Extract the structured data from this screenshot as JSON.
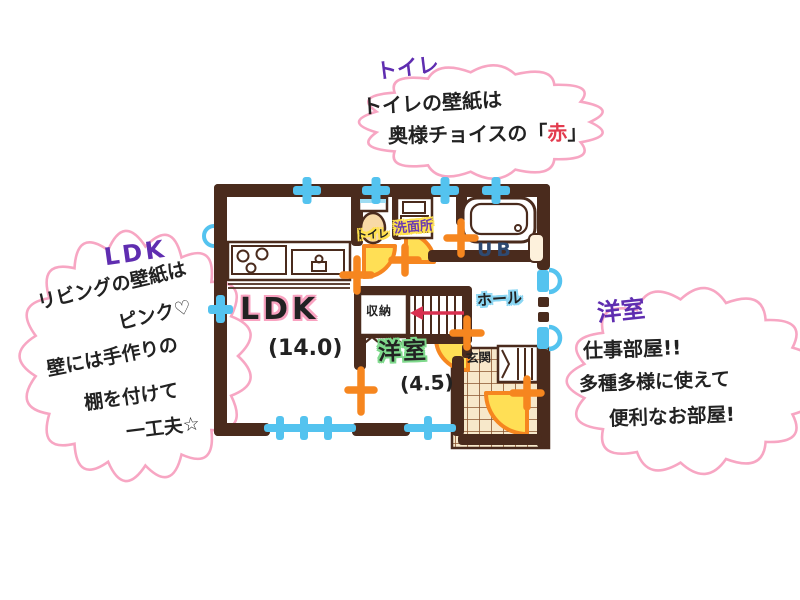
{
  "bubbles": {
    "toilet": {
      "title": "トイレ",
      "line1": "トイレの壁紙は",
      "line2_prefix": "奥様チョイスの「",
      "line2_accent": "赤",
      "line2_suffix": "」"
    },
    "ldk": {
      "title": "LDK",
      "lines": [
        "リビングの壁紙は",
        "ピンク♡",
        "壁には手作りの",
        "棚を付けて",
        "一工夫☆"
      ]
    },
    "youshitsu": {
      "title": "洋室",
      "lines": [
        "仕事部屋!!",
        "多種多様に使えて",
        "便利なお部屋!"
      ]
    }
  },
  "floorplan": {
    "rooms": {
      "ldk": {
        "name": "LDK",
        "size": "(14.0)"
      },
      "youshitsu": {
        "name": "洋室",
        "size": "(4.5)"
      },
      "toilet": {
        "name": "トイレ"
      },
      "washroom": {
        "name": "洗面所"
      },
      "bath": {
        "name": "UB"
      },
      "hall": {
        "name": "ホール"
      },
      "closet": {
        "name": "収納"
      },
      "entrance": {
        "name": "玄関"
      }
    },
    "colors": {
      "wall": "#4a2b1d",
      "window_blue": "#54c3ef",
      "door_orange": "#f6861f",
      "door_fill_yellow": "#ffdf55",
      "cloud_border_pink": "#f7a6c3",
      "title_purple": "#5f2db0",
      "accent_red": "#e33b4e",
      "stairs_arrow_red": "#d93050",
      "ldk_highlight": "#f9a2c0",
      "youshitsu_highlight": "#7fd98c",
      "hall_highlight": "#8ad6f3",
      "label_highlight_yellow": "#ffe14d",
      "tile_beige": "#f7e8ca"
    }
  }
}
